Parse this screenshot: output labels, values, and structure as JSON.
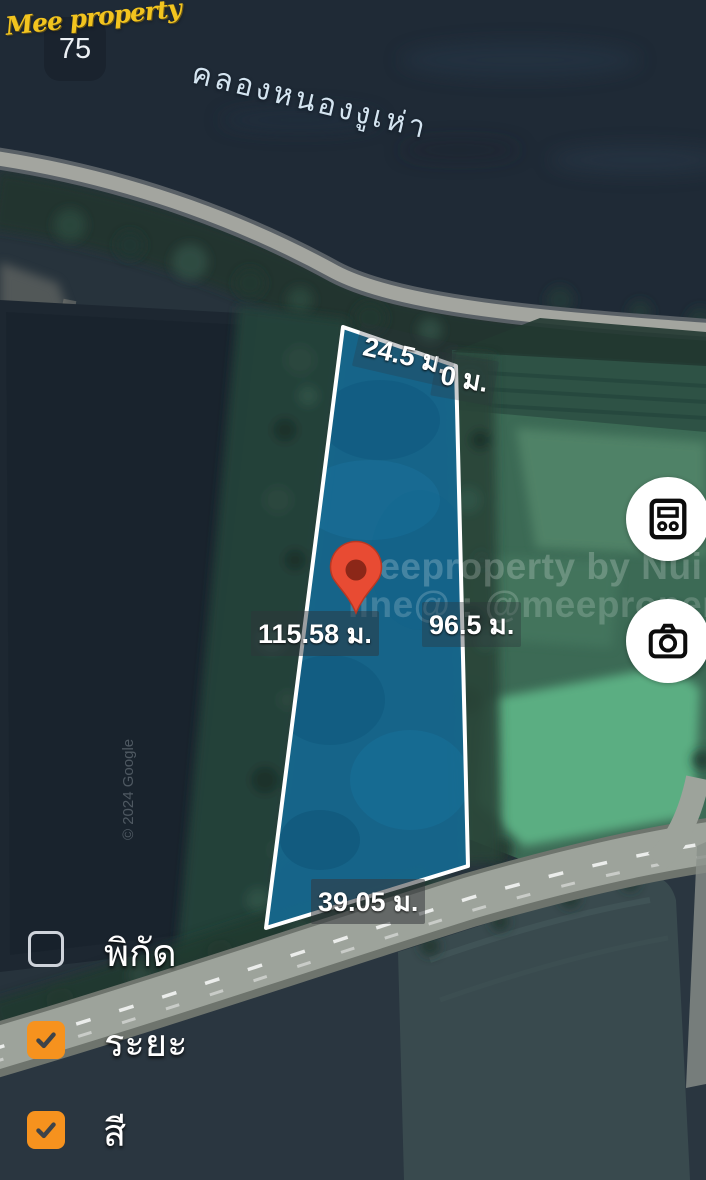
{
  "map": {
    "canal_label": "คลองหนองงูเห่า",
    "route_marker": "75",
    "logo_text": "Mee property",
    "watermark_line1": "Meeproperty by Nui",
    "watermark_line2": "line@ : @meeproperty",
    "attribution": "© 2024 Google",
    "measurements": {
      "top": "24.5 ม.",
      "zero": "0 ม.",
      "left": "115.58 ม.",
      "right": "96.5 ม.",
      "bottom": "39.05 ม."
    },
    "parcel": {
      "fill": "#15688F",
      "border": "#FFFFFF"
    },
    "pin_color": "#E84B33"
  },
  "controls": {
    "accent": "#F6921E",
    "checkboxes": [
      {
        "label": "พิกัด",
        "checked": false
      },
      {
        "label": "ระยะ",
        "checked": true
      },
      {
        "label": "สี",
        "checked": true
      }
    ],
    "buttons": [
      {
        "icon": "calculator-icon"
      },
      {
        "icon": "camera-icon"
      }
    ],
    "icons": {
      "checked": "check-icon",
      "layers_tool": "calculator-icon",
      "screenshot_tool": "camera-icon",
      "marker": "map-pin-icon"
    }
  }
}
